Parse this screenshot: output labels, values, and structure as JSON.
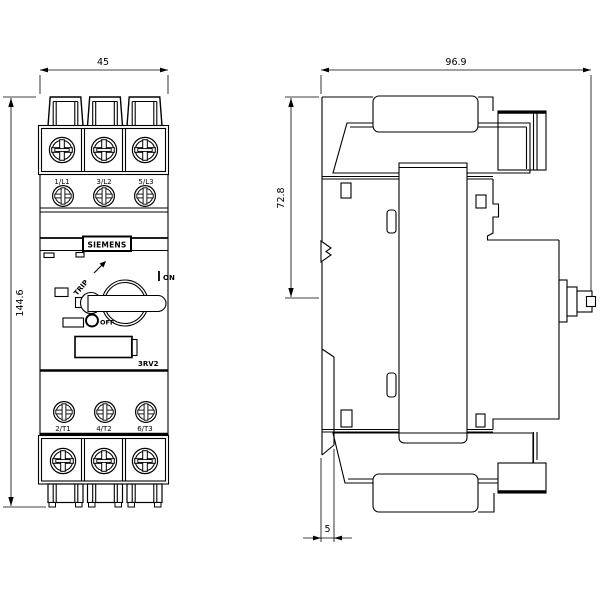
{
  "drawing": {
    "front": {
      "dim_width": "45",
      "dim_height": "144.6",
      "brand": "SIEMENS",
      "model": "3RV2",
      "terminals_top": [
        "1/L1",
        "3/L2",
        "5/L3"
      ],
      "terminals_bottom": [
        "2/T1",
        "4/T2",
        "6/T3"
      ],
      "switch": {
        "on": "ON",
        "off": "OFF",
        "trip": "TRIP"
      }
    },
    "side": {
      "dim_width": "96.9",
      "dim_upper_height": "72.8",
      "dim_offset": "5"
    },
    "colors": {
      "line": "#000000",
      "background": "#ffffff"
    }
  }
}
